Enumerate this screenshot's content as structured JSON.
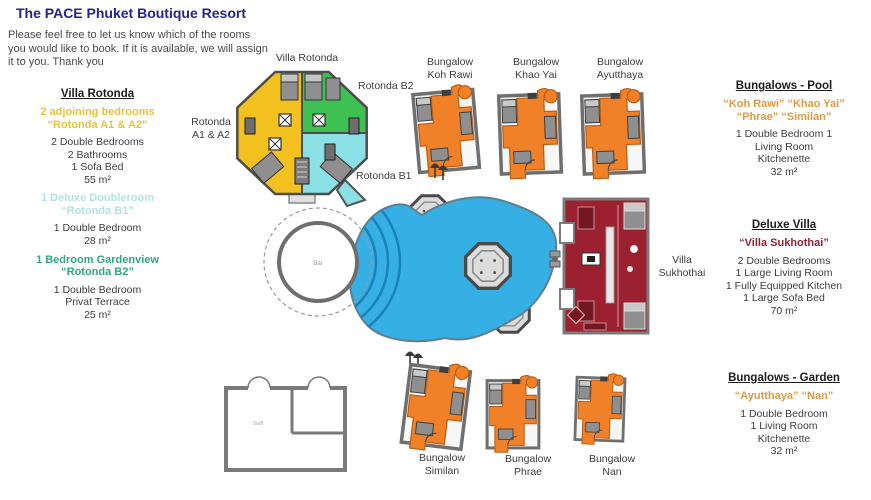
{
  "title": "The PACE Phuket Boutique Resort",
  "intro": "Please feel free to let us know which of the rooms\nyou would like to book. If it is available, we will assign\nit to you. Thank you",
  "left_column": {
    "heading": "Villa Rotonda",
    "sections": [
      {
        "name": "2 adjoining bedrooms\n“Rotonda A1 & A2”",
        "details": "2 Double Bedrooms\n2 Bathrooms\n1 Sofa Bed\n55 m²"
      },
      {
        "name": "1 Deluxe Doubleroom\n“Rotonda B1”",
        "details": "1 Double Bedroom\n28 m²"
      },
      {
        "name": "1 Bedroom Gardenview\n“Rotonda B2”",
        "details": "1 Double Bedroom\nPrivat Terrace\n25 m²"
      }
    ]
  },
  "right_column": {
    "pool": {
      "heading": "Bungalows - Pool",
      "names": "“Koh Rawi” “Khao Yai”\n“Phrae” “Similan”",
      "details": "1 Double Bedroom 1\nLiving Room\nKitchenette\n32 m²"
    },
    "deluxe": {
      "heading": "Deluxe Villa",
      "names": "“Villa Sukhothai”",
      "details": "2 Double Bedrooms\n1 Large Living Room\n1 Fully Equipped Kitchen\n1 Large Sofa Bed\n70 m²"
    },
    "garden": {
      "heading": "Bungalows - Garden",
      "names": "“Ayutthaya” “Nan”",
      "details": "1 Double Bedroom\n1 Living Room\nKitchenette\n32 m²"
    }
  },
  "map": {
    "villa_rotonda": "Villa Rotonda",
    "rotonda_a": "Rotonda\nA1 & A2",
    "rotonda_b2": "Rotonda B2",
    "rotonda_b1": "Rotonda B1",
    "bungalow_koh_rawi": "Bungalow\nKoh Rawi",
    "bungalow_khao_yai": "Bungalow\nKhao Yai",
    "bungalow_ayutthaya": "Bungalow\nAyutthaya",
    "villa_sukhothai": "Villa\nSukhothai",
    "bungalow_similan": "Bungalow\nSimilan",
    "bungalow_phrae": "Bungalow\nPhrae",
    "bungalow_nan": "Bungalow\nNan",
    "bar": "Bar",
    "staff": "Staff"
  },
  "colors": {
    "title": "#24248E",
    "rotonda_a_text": "#E4C33F",
    "rotonda_b1_text": "#AFE4E1",
    "rotonda_b2_text": "#2FA87C",
    "bungalow_text": "#DD9A43",
    "sukhothai_text": "#8E2433",
    "plan_yellow": "#F3C11F",
    "plan_green": "#3EC152",
    "plan_cyan": "#8BE0E6",
    "plan_orange": "#F08128",
    "plan_red": "#9C2130",
    "pool_blue": "#35AFE4",
    "wall_gray": "#757575"
  }
}
